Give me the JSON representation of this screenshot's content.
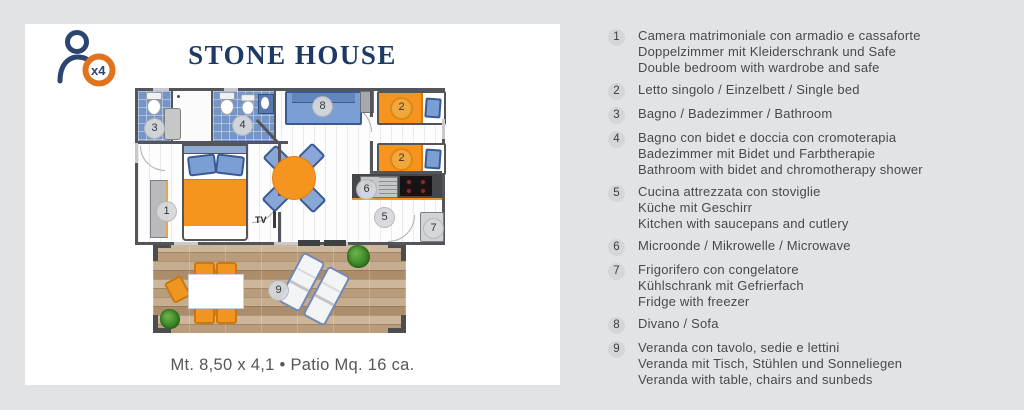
{
  "card": {
    "title": "STONE HOUSE",
    "logo_badge": "x4",
    "dimensions_note": "Mt. 8,50 x 4,1 • Patio Mq. 16 ca."
  },
  "colors": {
    "accent_orange": "#f5941f",
    "brand_navy": "#1d3a66",
    "furniture_blue": "#7b9fd4",
    "wall_gray": "#54555a"
  },
  "plan": {
    "markers": {
      "m1": "1",
      "m2": "2",
      "m3": "3",
      "m4": "4",
      "m5": "5",
      "m6": "6",
      "m7": "7",
      "m8": "8",
      "m9": "9",
      "tv": "TV"
    }
  },
  "legend": {
    "items": [
      {
        "num": "1",
        "lines": [
          "Camera matrimoniale con armadio e cassaforte",
          "Doppelzimmer mit Kleiderschrank und Safe",
          "Double bedroom with wardrobe and safe"
        ]
      },
      {
        "num": "2",
        "lines": [
          "Letto singolo / Einzelbett / Single bed"
        ]
      },
      {
        "num": "3",
        "lines": [
          "Bagno / Badezimmer / Bathroom"
        ]
      },
      {
        "num": "4",
        "lines": [
          "Bagno con bidet e doccia con cromoterapia",
          "Badezimmer mit Bidet und Farbtherapie",
          "Bathroom with bidet and chromotherapy shower"
        ]
      },
      {
        "num": "5",
        "lines": [
          "Cucina attrezzata con stoviglie",
          "Küche mit Geschirr",
          "Kitchen with saucepans and cutlery"
        ]
      },
      {
        "num": "6",
        "lines": [
          "Microonde / Mikrowelle / Microwave"
        ]
      },
      {
        "num": "7",
        "lines": [
          "Frigorifero con congelatore",
          "Kühlschrank mit Gefrierfach",
          "Fridge with freezer"
        ]
      },
      {
        "num": "8",
        "lines": [
          "Divano / Sofa"
        ]
      },
      {
        "num": "9",
        "lines": [
          "Veranda con tavolo, sedie e lettini",
          "Veranda mit Tisch, Stühlen und Sonneliegen",
          "Veranda with table, chairs and sunbeds"
        ]
      }
    ]
  }
}
